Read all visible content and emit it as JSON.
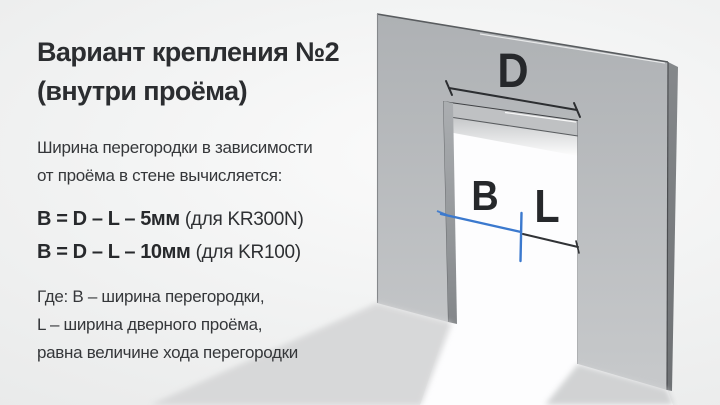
{
  "content": {
    "title": [
      "Вариант крепления №2",
      "(внутри проёма)"
    ],
    "intro": [
      "Ширина перегородки в зависимости",
      "от проёма в стене вычисляется:"
    ],
    "formulas": [
      {
        "expr": "B = D – L – 5мм ",
        "note": "(для KR300N)"
      },
      {
        "expr": "B = D – L – 10мм ",
        "note": "(для KR100)"
      }
    ],
    "legend": [
      "Где: B – ширина перегородки,",
      "L – ширина дверного проёма,",
      "равна величине хода перегородки"
    ]
  },
  "diagram": {
    "label_opening_width": "D",
    "label_partition_width": "B",
    "label_travel_width": "L",
    "colors": {
      "accent_blue": "#3b79ce",
      "wall_gray": "#b9bcbf",
      "dimension_dark": "#2e3033",
      "text_dark": "#2b2d30"
    }
  }
}
